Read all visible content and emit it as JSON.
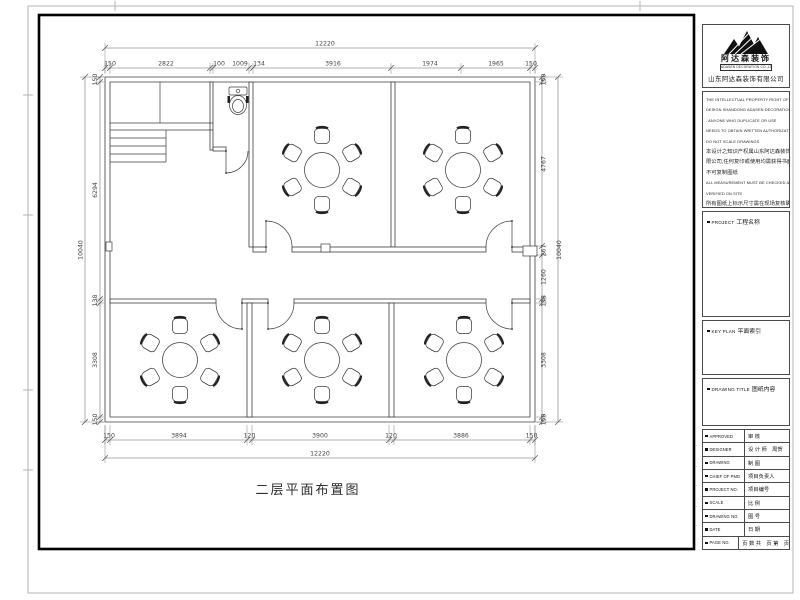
{
  "sheet": {
    "plan_title": "二层平面布置图"
  },
  "plan": {
    "dims": {
      "top_overall": "12220",
      "top": [
        "150",
        "2822",
        "100",
        "1009",
        "134",
        "3916",
        "1974",
        "1965",
        "150"
      ],
      "bottom": [
        "150",
        "3894",
        "120",
        "3900",
        "120",
        "3886",
        "150"
      ],
      "bottom_overall": "12220",
      "left": [
        "150",
        "6294",
        "138",
        "3308",
        "150"
      ],
      "left_overall": "10040",
      "right": [
        "150",
        "4767",
        "267",
        "1260",
        "138",
        "3308",
        "150"
      ],
      "right_overall": "10040"
    }
  },
  "title_block": {
    "logo_name": "阿达森装饰",
    "logo_tagline": "ADASEN DECORATION CO.,LTD",
    "company": "山东阿达森装饰有限公司",
    "disclaimer_lines": [
      "THE INTELLECTUAL PROPERTY RIGHT OF THIS",
      "DESIGN SHANDONG ADASEN DECORATION CO.,LTD",
      ". ANYONE WHO DUPLICATE OR USE",
      "NEEDS TO OBTAIN WRITTEN AUTHORIZATION",
      "DO NOT SCALE DRAWINGS",
      "本设计之知识产权属山东阿达森装饰有",
      "限公司,任何复印或使用均需获得书面授权,",
      "不可复制图纸",
      "ALL MEASUREMENT MUST BE CHECKED AND",
      "VERIFIED ON SITE",
      "所有图纸上标示尺寸需在现场复核确定"
    ],
    "sections": {
      "project": {
        "en": "PROJECT",
        "cn": "工程名称"
      },
      "key_plan": {
        "en": "KEY PLAN",
        "cn": "平面索引"
      },
      "drawing_title": {
        "en": "DRAWING TITLE",
        "cn": "图纸内容"
      }
    },
    "rows": [
      {
        "en": "APPROVED",
        "cn": "审 核"
      },
      {
        "en": "DESIGNER",
        "cn": "设 计 师　周贺"
      },
      {
        "en": "DRAWING",
        "cn": "制 图"
      },
      {
        "en": "CHIEF OF PMD",
        "cn": "项目负责人"
      },
      {
        "en": "PROJECT NO.",
        "cn": "项目编号"
      },
      {
        "en": "SCALE",
        "cn": "比 例"
      },
      {
        "en": "DRAWING NO.",
        "cn": "图 号"
      },
      {
        "en": "DATE",
        "cn": "日 期"
      },
      {
        "en": "PAGE NO.",
        "cn": "页 数 共　页 第　页"
      }
    ]
  }
}
